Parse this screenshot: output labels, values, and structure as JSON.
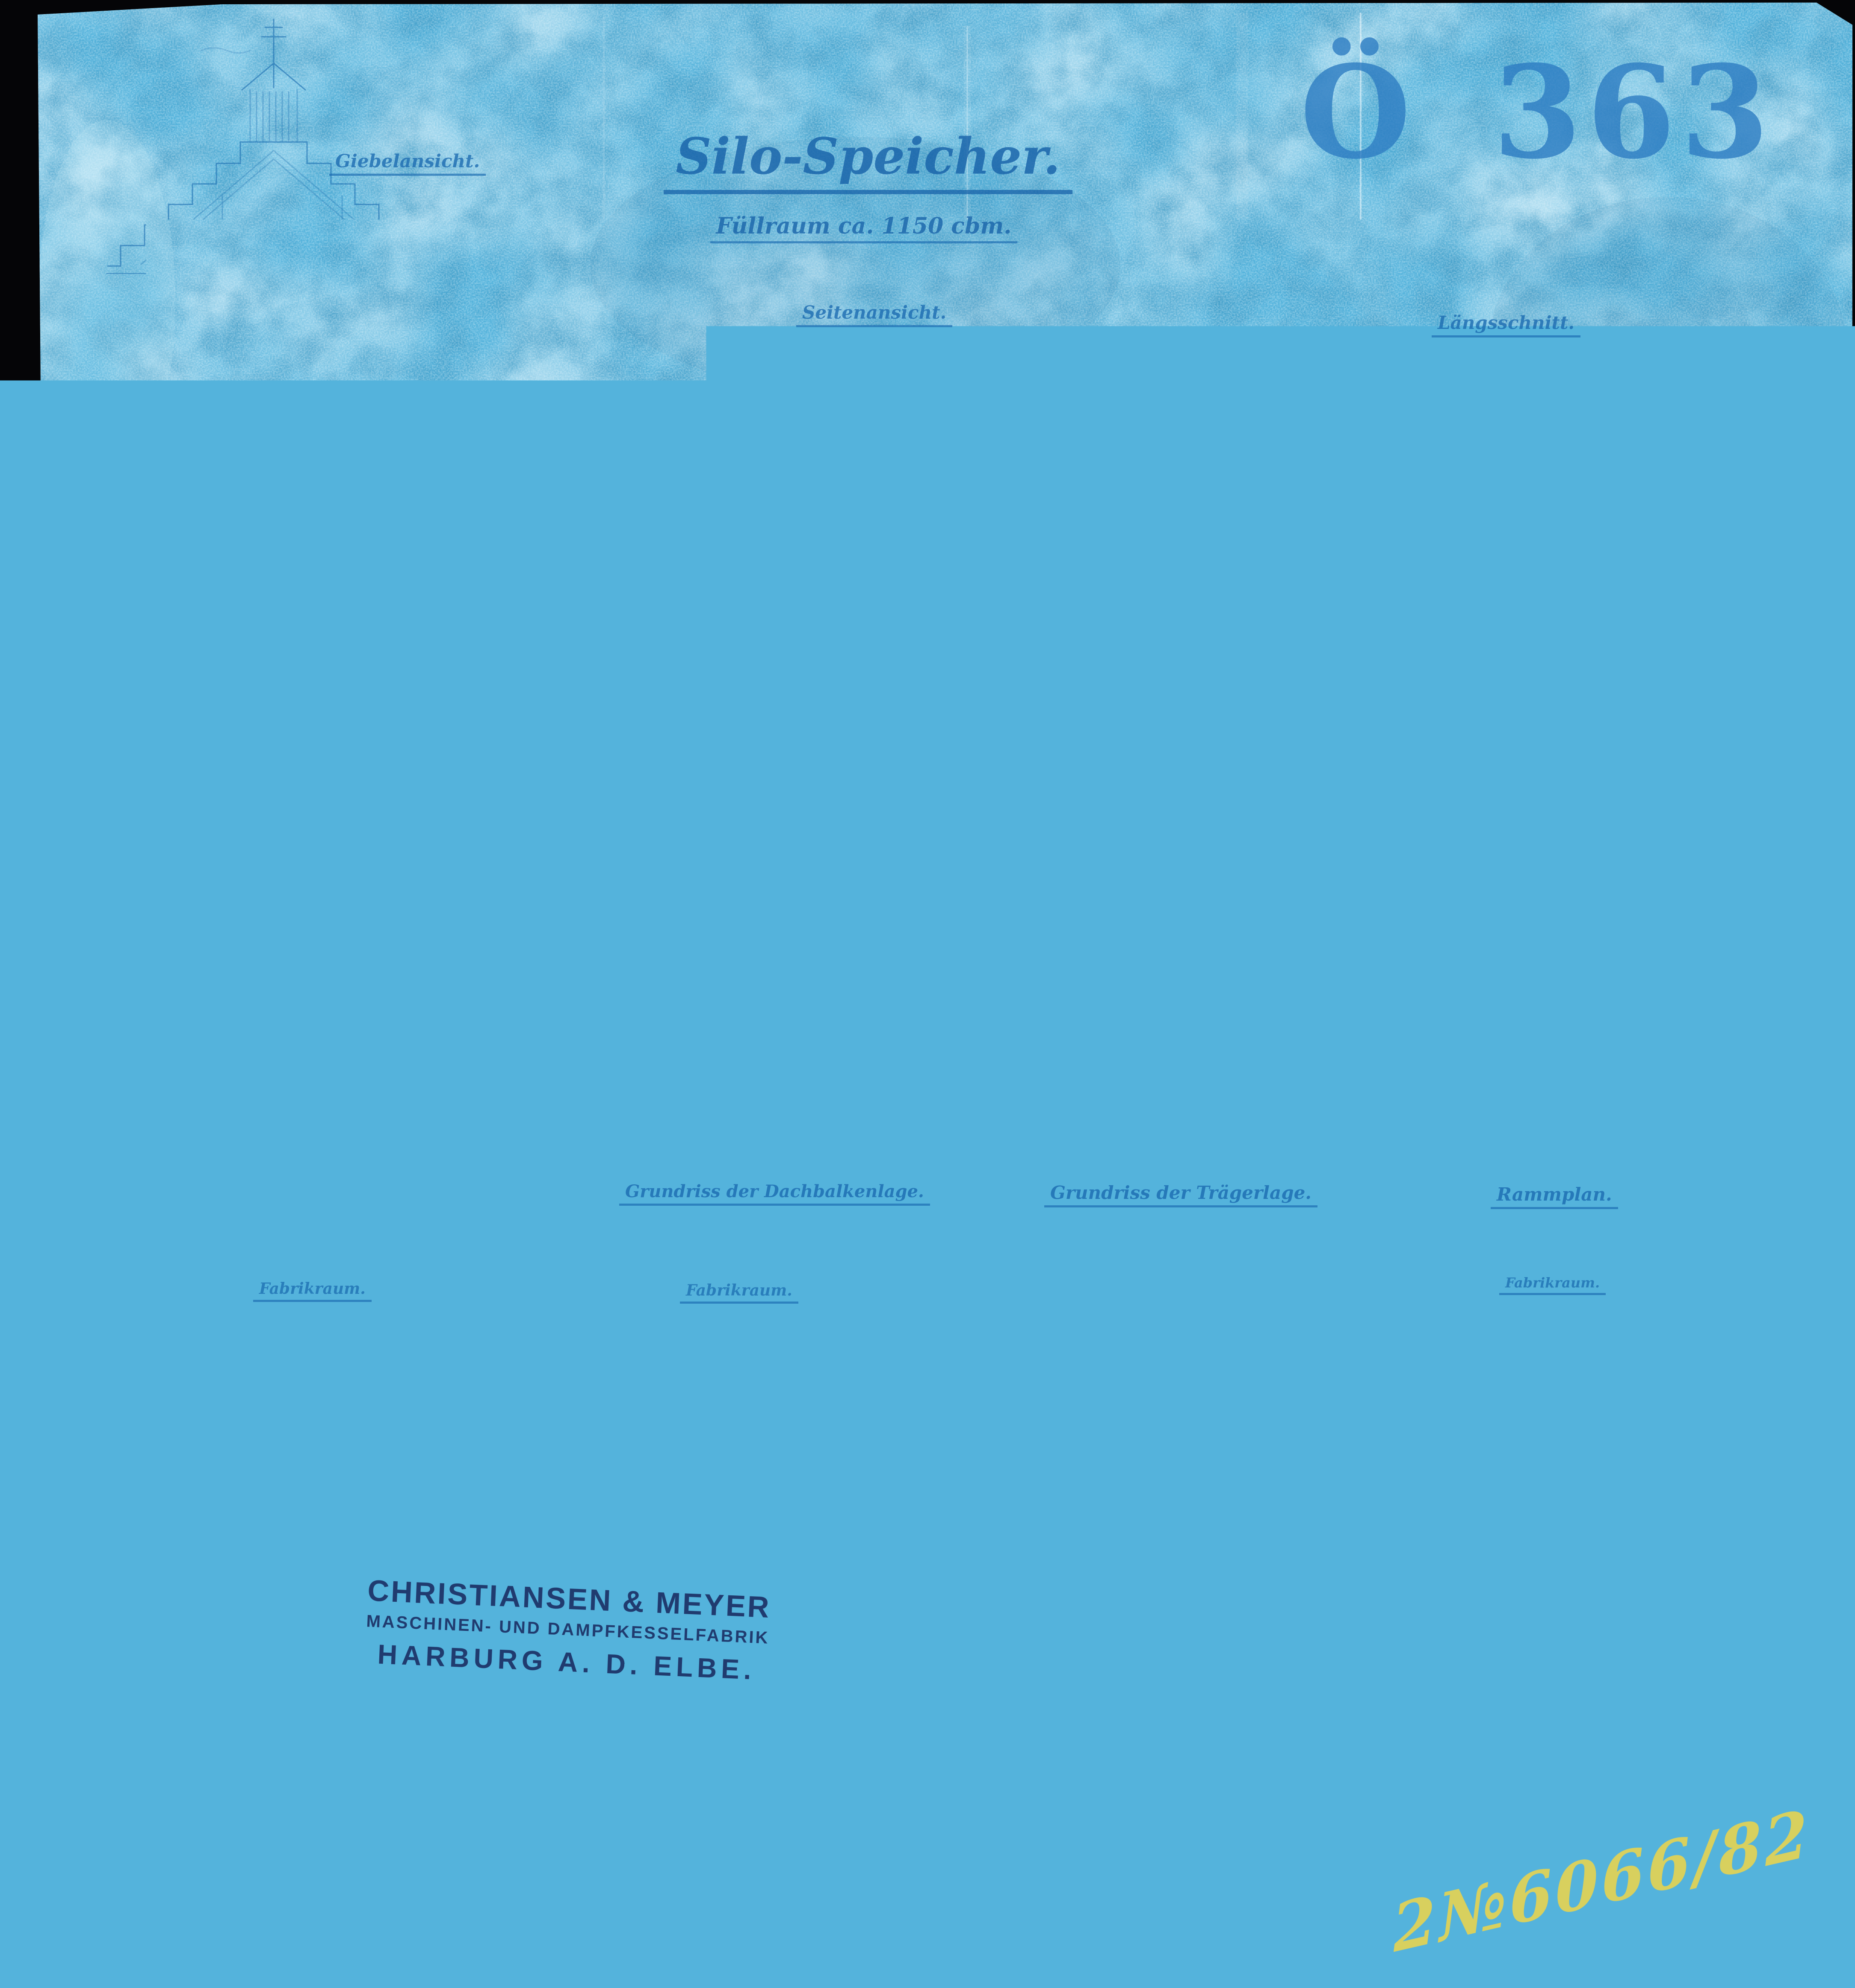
{
  "document": {
    "type": "cyanotype blueprint drawing",
    "archive_stamp": "Ö 363",
    "title": "Silo-Speicher.",
    "subtitle": "Füllraum ca. 1150 cbm.",
    "handwritten_note": "2№6066/82"
  },
  "view_labels": {
    "gable_section": "Giebelansicht.",
    "side_elevation": "Seitenansicht.",
    "longitudinal_section": "Längsschnitt.",
    "silo_floor_plan": "Silolager-Grundriss.",
    "roof_beam_plan": "Grundriss der Dachbalkenlage.",
    "girder_plan": "Grundriss der Trägerlage.",
    "piling_plan": "Rammplan."
  },
  "room_labels": {
    "plan1": "Fabrikraum.",
    "plan2": "Fabrikraum.",
    "plan4": "Fabrikraum."
  },
  "maker_stamp": {
    "line1": "CHRISTIANSEN & MEYER",
    "line2": "MASCHINEN- UND DAMPFKESSELFABRIK",
    "line3": "HARBURG A. D. ELBE."
  },
  "colors": {
    "paper_blue": "#54b3dc",
    "line_blue": "#1a6cb0",
    "stamp_blue": "#2d7cc2",
    "maker_navy": "#182a60",
    "note_yellow": "#e7d348",
    "scan_background": "#050507"
  }
}
